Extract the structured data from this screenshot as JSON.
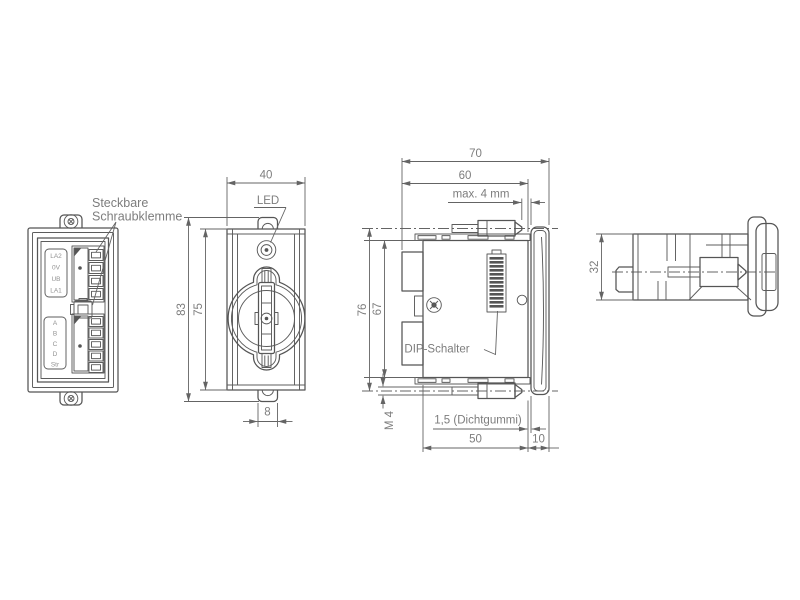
{
  "drawing": {
    "background_color": "#ffffff",
    "line_color": "#555555",
    "text_color": "#7d7d7d",
    "views": {
      "rear": {
        "callout_line1": "Steckbare",
        "callout_line2": "Schraubklemme",
        "terminal_top_labels": [
          "LA2",
          "0V",
          "UB",
          "LA1"
        ],
        "terminal_bottom_labels": [
          "A",
          "B",
          "C",
          "D",
          "Str"
        ]
      },
      "front": {
        "dim_width": "40",
        "led_label": "LED",
        "dim_total_height": "83",
        "dim_plate_height": "75",
        "dim_tab_width": "8"
      },
      "side": {
        "dim_total_depth": "70",
        "dim_mount_depth": "60",
        "dim_panel_thickness": "max. 4 mm",
        "dim_clamp_span": "76",
        "dim_body_height": "67",
        "dip_switch_label": "DIP-Schalter",
        "dim_screw_thread": "M 4",
        "dim_seal": "1,5 (Dichtgummi)",
        "dim_body_depth": "50",
        "dim_bezel_depth": "10"
      },
      "profile": {
        "dim_height": "32"
      }
    }
  }
}
